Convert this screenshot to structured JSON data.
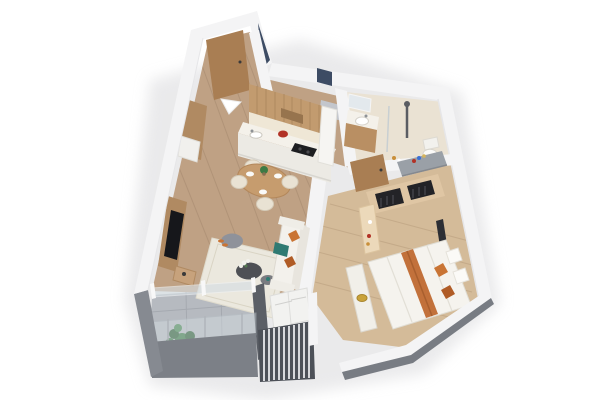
{
  "scene": {
    "type": "3d-floor-plan-render",
    "description": "Isometric 3D render of a one-bedroom apartment floor plan on a white background",
    "rooms": [
      "entry-hall",
      "kitchen",
      "dining-area",
      "living-room",
      "bathroom",
      "bedroom",
      "balcony",
      "ac-unit-enclosure"
    ],
    "objects": [
      "entry-door",
      "entrance-arrow",
      "wood-wall-panel",
      "shoe-cabinet",
      "kitchen-upper-cabinets",
      "range-hood",
      "backsplash",
      "kitchen-counter",
      "cooktop",
      "red-kettle",
      "kitchen-sink",
      "tall-cabinet",
      "dining-table",
      "dining-chairs",
      "tableware",
      "table-centerpiece",
      "tv-panel",
      "television",
      "media-console",
      "floor-rug",
      "pouf",
      "slippers",
      "coffee-table",
      "flower-vase",
      "side-table",
      "sofa",
      "sofa-cushions",
      "teal-throw",
      "vanity-mirror",
      "bathroom-vanity",
      "bathroom-sink",
      "shower-column",
      "shower-glass",
      "toilet",
      "bedroom-door",
      "wardrobe",
      "open-shelf",
      "vanity-desk",
      "nightstand",
      "double-bed",
      "bed-runner",
      "bed-pillows",
      "bed-bench",
      "gold-tray",
      "wall-mirror",
      "balcony-plant",
      "plant-pot",
      "glass-sliding-door",
      "glass-railing",
      "ac-outdoor-units",
      "louver-screen"
    ]
  },
  "colors": {
    "background": "#ffffff",
    "shadow": "#d9d9dc",
    "wall_white": "#f4f4f5",
    "wall_edge": "#e6e6e8",
    "wall_top_slate": "#3d4c64",
    "glass_blue": "#c3cdd8",
    "wood_floor": "#bfa184",
    "wood_plank_line": "#9c8166",
    "hall_floor": "#c9ac8c",
    "bedroom_floor": "#d4bb99",
    "bedroom_plank_line": "#b29776",
    "bath_floor": "#eae2d3",
    "balcony_tile": "#b6bac0",
    "balcony_tile_line": "#a2a6ad",
    "balcony_wall_gray": "#868a91",
    "balcony_wall_face": "#7c8087",
    "se_wall_gray": "#787c83",
    "divider_wall_dark": "#5b5f66",
    "louver_dark": "#4d5158",
    "louver_slat": "#e9e9eb",
    "ac_white": "#f2f2f0",
    "glass_rail": "#d6dee3",
    "door_wood": "#a97e53",
    "panel_wood": "#b08a62",
    "cabinet_wood": "#c29b6f",
    "cabinet_slat": "#a8845c",
    "hood_wood": "#97744e",
    "backsplash": "#efe7d6",
    "counter_white": "#f4f1ea",
    "cabinet_white": "#eceae4",
    "cooktop_black": "#1d1e21",
    "kettle_red": "#b23226",
    "table_wood": "#c69c6e",
    "chair_cream": "#e9e2d3",
    "plate_white": "#fafaf8",
    "rug_cream": "#ebe8de",
    "pouf_gray": "#8f929a",
    "coffee_table_dark": "#4e5055",
    "side_table_gray": "#797b80",
    "sofa_white": "#f3f1ec",
    "sofa_shade": "#e8e5de",
    "cushion_orange": "#c97434",
    "cushion_orange_dark": "#b05c26",
    "throw_teal": "#2f7a72",
    "tv_black": "#16171b",
    "vanity_wood": "#b98f63",
    "mirror_glass": "#e3e9ed",
    "fixture_gray": "#5a5d63",
    "fixture_white": "#f2f1ed",
    "bed_white": "#f5f3ee",
    "bed_shadow": "#e2dfd6",
    "runner_orange": "#c2713b",
    "white_pillow": "#fbfaf7",
    "bench_white": "#f1efe9",
    "tray_gold": "#c9a23a",
    "wardrobe_wood": "#dfc6a4",
    "wardrobe_dark": "#232327",
    "shelf_cream": "#ecd9ba",
    "desk_gray": "#9aa0a7",
    "mirror_dark": "#2c2e34",
    "plant_green": "#3c7a44",
    "plant_green_dark": "#2c5f34",
    "plant_green_light": "#47874f",
    "pot_white": "#fafafa",
    "arrow_white": "#ffffff"
  }
}
